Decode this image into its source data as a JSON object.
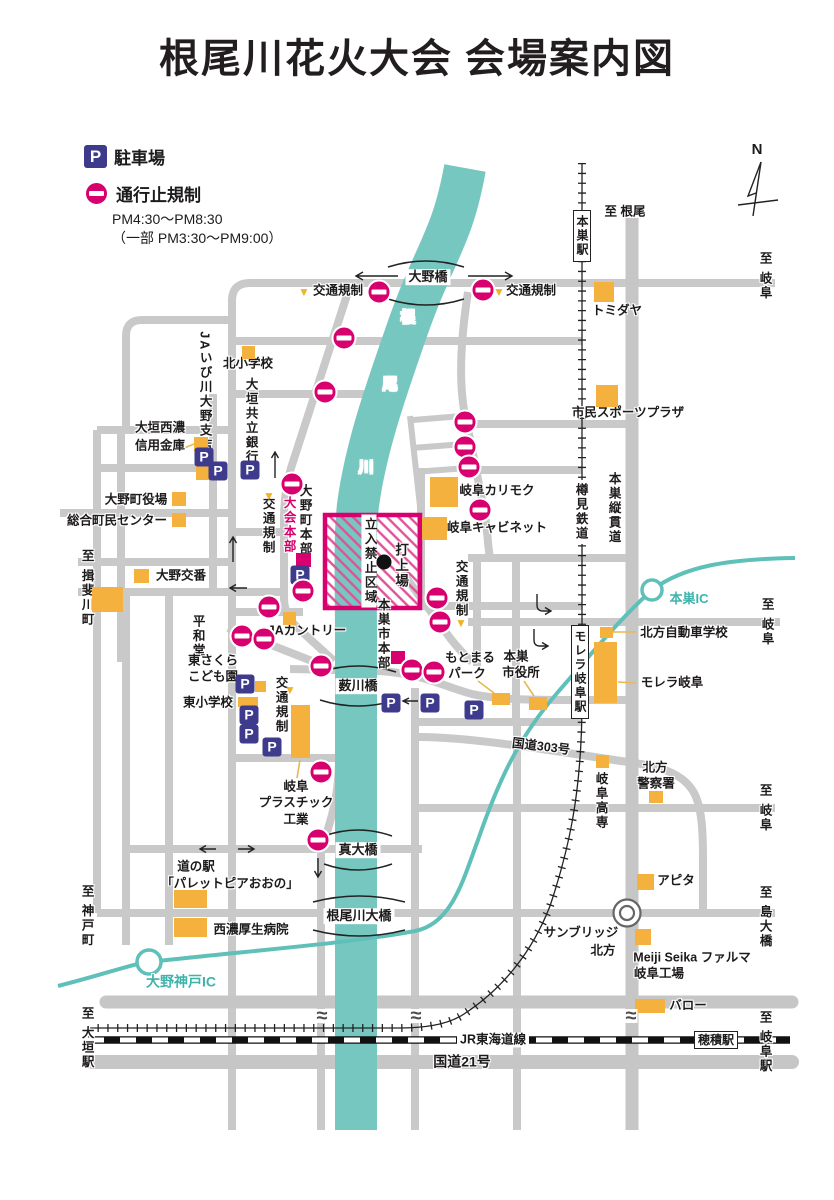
{
  "title": "根尾川花火大会 会場案内図",
  "legend": {
    "parking_symbol": "P",
    "parking_label": "駐車場",
    "closure_label": "通行止規制",
    "closure_time1": "PM4:30〜PM8:30",
    "closure_time2": "（一部 PM3:30〜PM9:00）"
  },
  "colors": {
    "magenta": "#d7006e",
    "orange": "#f4b13d",
    "navy": "#3e3a8c",
    "river": "#77c7c1",
    "highway": "#5fc0b9",
    "road": "#c9c9c9",
    "triangle_yellow": "#efb32a",
    "text": "#1d1a1a"
  },
  "symbols": {
    "triangle": "▼",
    "wave": "≈"
  },
  "map": {
    "labels": [
      {
        "n": "compass-n",
        "t": "N",
        "x": 757,
        "y": 150,
        "s": 15
      },
      {
        "n": "to-neo",
        "t": "至 根尾",
        "x": 625,
        "y": 212
      },
      {
        "n": "to-gifu-top",
        "t": "至 岐阜",
        "x": 764,
        "y": 276,
        "v": 1
      },
      {
        "n": "tomidaya",
        "t": "トミダヤ",
        "x": 617,
        "y": 311
      },
      {
        "n": "shimin-sports-plaza",
        "t": "市民スポーツプラザ",
        "x": 628,
        "y": 413
      },
      {
        "n": "kotsu-kisei-1",
        "t": "交通規制",
        "x": 338,
        "y": 291
      },
      {
        "n": "kotsu-kisei-2",
        "t": "交通規制",
        "x": 531,
        "y": 291
      },
      {
        "n": "river-1",
        "t": "根",
        "x": 408,
        "y": 318,
        "c": "#fff",
        "s": 15
      },
      {
        "n": "river-2",
        "t": "尾",
        "x": 390,
        "y": 385,
        "c": "#fff",
        "s": 15
      },
      {
        "n": "river-3",
        "t": "川",
        "x": 366,
        "y": 468,
        "c": "#fff",
        "s": 15
      },
      {
        "n": "kita-elementary",
        "t": "北小学校",
        "x": 248,
        "y": 364
      },
      {
        "n": "ja-ibigawa",
        "t": "JAいび川大野支店",
        "x": 204,
        "y": 392,
        "v": 1
      },
      {
        "n": "ogaki-kyoritsu-bank",
        "t": "大垣共立銀行",
        "x": 250,
        "y": 421,
        "v": 1
      },
      {
        "n": "ogaki-seino-1",
        "t": "大垣西濃",
        "x": 160,
        "y": 428
      },
      {
        "n": "ogaki-seino-2",
        "t": "信用金庫",
        "x": 160,
        "y": 446
      },
      {
        "n": "onocho-yakuba",
        "t": "大野町役場",
        "x": 136,
        "y": 500
      },
      {
        "n": "sogo-chomin-center",
        "t": "総合町民センター",
        "x": 117,
        "y": 521
      },
      {
        "n": "ono-koban",
        "t": "大野交番",
        "x": 181,
        "y": 576
      },
      {
        "n": "to-ibigawacho",
        "t": "至 揖斐川町",
        "x": 86,
        "y": 588,
        "v": 1
      },
      {
        "n": "heiwado",
        "t": "平和堂",
        "x": 197,
        "y": 636,
        "v": 1
      },
      {
        "n": "kotsu-kisei-3",
        "t": "交通規制",
        "x": 267,
        "y": 526,
        "v": 1
      },
      {
        "n": "taikai-honbu",
        "t": "大会本部",
        "x": 288,
        "y": 525,
        "v": 1,
        "c": "#d7006e"
      },
      {
        "n": "onocho-honbu",
        "t": "大野町本部",
        "x": 304,
        "y": 520,
        "v": 1
      },
      {
        "n": "restricted-zone",
        "t": "立入禁止区域",
        "x": 369,
        "y": 561,
        "v": 1,
        "bg": 1
      },
      {
        "n": "launch-site",
        "t": "打上場",
        "x": 400,
        "y": 566,
        "v": 1,
        "s": 13.5
      },
      {
        "n": "kotsu-kisei-4",
        "t": "交通規制",
        "x": 460,
        "y": 589,
        "v": 1
      },
      {
        "n": "gifu-karimoku",
        "t": "岐阜カリモク",
        "x": 497,
        "y": 491
      },
      {
        "n": "gifu-cabinet",
        "t": "岐阜キャビネット",
        "x": 497,
        "y": 528
      },
      {
        "n": "tarumi-railway",
        "t": "樽見鉄道",
        "x": 580,
        "y": 512,
        "v": 1,
        "bg": 1
      },
      {
        "n": "motosu-jukando",
        "t": "本巣縦貫道",
        "x": 613,
        "y": 508,
        "v": 1
      },
      {
        "n": "motosu-ic",
        "t": "本巣IC",
        "x": 689,
        "y": 599,
        "c": "#3fb3ab",
        "s": 13
      },
      {
        "n": "to-gifu-mid",
        "t": "至 岐阜",
        "x": 766,
        "y": 622,
        "v": 1
      },
      {
        "n": "ja-country",
        "t": "JAカントリー",
        "x": 307,
        "y": 631
      },
      {
        "n": "motosu-shi-honbu",
        "t": "本巣市本部",
        "x": 382,
        "y": 634,
        "v": 1
      },
      {
        "n": "motomaru-park-1",
        "t": "もとまる",
        "x": 470,
        "y": 658
      },
      {
        "n": "motomaru-park-2",
        "t": "パーク",
        "x": 467,
        "y": 674
      },
      {
        "n": "motosu-shiyakusho-1",
        "t": "本巣",
        "x": 516,
        "y": 657
      },
      {
        "n": "motosu-shiyakusho-2",
        "t": "市役所",
        "x": 521,
        "y": 673
      },
      {
        "n": "kitagata-driving-school",
        "t": "北方自動車学校",
        "x": 684,
        "y": 633
      },
      {
        "n": "malera-gifu",
        "t": "モレラ岐阜",
        "x": 672,
        "y": 683
      },
      {
        "n": "higashi-sakura-1",
        "t": "東さくら",
        "x": 213,
        "y": 661
      },
      {
        "n": "higashi-sakura-2",
        "t": "こども園",
        "x": 213,
        "y": 677
      },
      {
        "n": "higashi-elementary",
        "t": "東小学校",
        "x": 208,
        "y": 703
      },
      {
        "n": "kotsu-kisei-5",
        "t": "交通規制",
        "x": 280,
        "y": 705,
        "v": 1
      },
      {
        "n": "gifu-plastic-1",
        "t": "岐阜",
        "x": 296,
        "y": 787
      },
      {
        "n": "gifu-plastic-2",
        "t": "プラスチック",
        "x": 296,
        "y": 803
      },
      {
        "n": "gifu-plastic-3",
        "t": "工業",
        "x": 296,
        "y": 820
      },
      {
        "n": "route-303",
        "t": "国道303号",
        "x": 541,
        "y": 747,
        "rot": 7
      },
      {
        "n": "gifu-kosen",
        "t": "岐阜高専",
        "x": 600,
        "y": 801,
        "v": 1
      },
      {
        "n": "kitagata-police-1",
        "t": "北方",
        "x": 655,
        "y": 768
      },
      {
        "n": "kitagata-police-2",
        "t": "警察署",
        "x": 656,
        "y": 784
      },
      {
        "n": "to-gifu-low",
        "t": "至 岐阜",
        "x": 764,
        "y": 808,
        "v": 1
      },
      {
        "n": "michinoeki-1",
        "t": "道の駅",
        "x": 196,
        "y": 867
      },
      {
        "n": "michinoeki-2",
        "t": "「パレットピアおおの」",
        "x": 230,
        "y": 884
      },
      {
        "n": "seino-kosei-hospital",
        "t": "西濃厚生病院",
        "x": 251,
        "y": 930
      },
      {
        "n": "ono-kobe-ic",
        "t": "大野神戸IC",
        "x": 181,
        "y": 982,
        "c": "#3fb3ab",
        "s": 14
      },
      {
        "n": "to-kobecho",
        "t": "至 神戸町",
        "x": 86,
        "y": 916,
        "v": 1
      },
      {
        "n": "apita",
        "t": "アピタ",
        "x": 676,
        "y": 881
      },
      {
        "n": "to-shimaohashi",
        "t": "至 島大橋",
        "x": 764,
        "y": 917,
        "v": 1
      },
      {
        "n": "sunbridge-1",
        "t": "サンブリッジ",
        "x": 581,
        "y": 933
      },
      {
        "n": "sunbridge-2",
        "t": "北方",
        "x": 603,
        "y": 951
      },
      {
        "n": "meiji-seika-1",
        "t": "Meiji Seika ファルマ",
        "x": 692,
        "y": 958
      },
      {
        "n": "meiji-seika-2",
        "t": "岐阜工場",
        "x": 659,
        "y": 974
      },
      {
        "n": "valor",
        "t": "バロー",
        "x": 688,
        "y": 1006
      },
      {
        "n": "jr-tokaido-line",
        "t": "JR東海道線",
        "x": 493,
        "y": 1040,
        "bg": 1
      },
      {
        "n": "route-21",
        "t": "国道21号",
        "x": 462,
        "y": 1062,
        "s": 14
      },
      {
        "n": "to-ogaki-sta",
        "t": "至 大垣駅",
        "x": 86,
        "y": 1038,
        "v": 1
      },
      {
        "n": "to-gifu-sta",
        "t": "至 岐阜駅",
        "x": 764,
        "y": 1042,
        "v": 1
      }
    ],
    "bridges": [
      {
        "n": "ono-bashi",
        "t": "大野橋",
        "x": 428,
        "y": 277
      },
      {
        "n": "yabukawa-bashi",
        "t": "薮川橋",
        "x": 358,
        "y": 686
      },
      {
        "n": "shindai-bashi",
        "t": "真大橋",
        "x": 358,
        "y": 850
      },
      {
        "n": "neogawa-ohashi",
        "t": "根尾川大橋",
        "x": 359,
        "y": 916
      }
    ],
    "stations": [
      {
        "n": "motosu-station",
        "t": "本巣駅",
        "x": 582,
        "y": 236,
        "v": 1
      },
      {
        "n": "malera-gifu-station",
        "t": "モレラ岐阜駅",
        "x": 580,
        "y": 672,
        "v": 1
      },
      {
        "n": "hozumi-station",
        "t": "穂積駅",
        "x": 716,
        "y": 1040,
        "v": 0
      }
    ],
    "buildings": [
      {
        "n": "tomidaya",
        "x": 594,
        "y": 282,
        "w": 20,
        "h": 20
      },
      {
        "n": "shimin-sports",
        "x": 596,
        "y": 385,
        "w": 22,
        "h": 22
      },
      {
        "n": "kita-elementary",
        "x": 242,
        "y": 346,
        "w": 13,
        "h": 13
      },
      {
        "n": "shinyokinko-1",
        "x": 194,
        "y": 437,
        "w": 14,
        "h": 14
      },
      {
        "n": "shinyokinko-2",
        "x": 196,
        "y": 466,
        "w": 13,
        "h": 14
      },
      {
        "n": "yakuba",
        "x": 172,
        "y": 492,
        "w": 14,
        "h": 14
      },
      {
        "n": "chomin-center",
        "x": 172,
        "y": 513,
        "w": 14,
        "h": 14
      },
      {
        "n": "koban",
        "x": 134,
        "y": 569,
        "w": 15,
        "h": 14
      },
      {
        "n": "heiwado",
        "x": 92,
        "y": 587,
        "w": 31,
        "h": 25
      },
      {
        "n": "ja-country",
        "x": 283,
        "y": 612,
        "w": 13,
        "h": 13
      },
      {
        "n": "karimoku",
        "x": 430,
        "y": 477,
        "w": 28,
        "h": 30
      },
      {
        "n": "cabinet",
        "x": 422,
        "y": 517,
        "w": 25,
        "h": 23
      },
      {
        "n": "sakura-kodomoen",
        "x": 255,
        "y": 681,
        "w": 11,
        "h": 11
      },
      {
        "n": "higashi-elementary",
        "x": 238,
        "y": 697,
        "w": 20,
        "h": 10
      },
      {
        "n": "gifu-plastic",
        "x": 291,
        "y": 705,
        "w": 19,
        "h": 53
      },
      {
        "n": "motomaru",
        "x": 492,
        "y": 693,
        "w": 18,
        "h": 12
      },
      {
        "n": "shiyakusho",
        "x": 529,
        "y": 697,
        "w": 18,
        "h": 13
      },
      {
        "n": "driving-school",
        "x": 600,
        "y": 627,
        "w": 13,
        "h": 11
      },
      {
        "n": "malera",
        "x": 594,
        "y": 642,
        "w": 23,
        "h": 61
      },
      {
        "n": "kosen",
        "x": 596,
        "y": 755,
        "w": 13,
        "h": 13
      },
      {
        "n": "police",
        "x": 649,
        "y": 791,
        "w": 14,
        "h": 12
      },
      {
        "n": "michinoeki",
        "x": 174,
        "y": 890,
        "w": 33,
        "h": 18
      },
      {
        "n": "seino-hospital",
        "x": 174,
        "y": 918,
        "w": 33,
        "h": 19
      },
      {
        "n": "apita",
        "x": 637,
        "y": 874,
        "w": 17,
        "h": 16
      },
      {
        "n": "meiji-seika",
        "x": 635,
        "y": 929,
        "w": 16,
        "h": 16
      },
      {
        "n": "valor",
        "x": 635,
        "y": 999,
        "w": 30,
        "h": 14
      }
    ],
    "hq_squares": [
      {
        "n": "taikai-honbu-marker",
        "x": 296,
        "y": 553,
        "w": 15,
        "h": 14
      },
      {
        "n": "motosu-honbu-marker",
        "x": 391,
        "y": 651,
        "w": 14,
        "h": 13
      }
    ],
    "parking": [
      {
        "x": 204,
        "y": 457
      },
      {
        "x": 218,
        "y": 471
      },
      {
        "x": 250,
        "y": 470
      },
      {
        "x": 300,
        "y": 575
      },
      {
        "x": 245,
        "y": 684
      },
      {
        "x": 249,
        "y": 715
      },
      {
        "x": 249,
        "y": 734
      },
      {
        "x": 272,
        "y": 747
      },
      {
        "x": 391,
        "y": 703
      },
      {
        "x": 430,
        "y": 703
      },
      {
        "x": 474,
        "y": 710
      }
    ],
    "no_entry": [
      {
        "x": 379,
        "y": 292
      },
      {
        "x": 483,
        "y": 290
      },
      {
        "x": 344,
        "y": 338
      },
      {
        "x": 325,
        "y": 392
      },
      {
        "x": 292,
        "y": 484
      },
      {
        "x": 303,
        "y": 591
      },
      {
        "x": 269,
        "y": 607
      },
      {
        "x": 242,
        "y": 636
      },
      {
        "x": 264,
        "y": 639
      },
      {
        "x": 321,
        "y": 666
      },
      {
        "x": 437,
        "y": 598
      },
      {
        "x": 440,
        "y": 622
      },
      {
        "x": 412,
        "y": 670
      },
      {
        "x": 434,
        "y": 672
      },
      {
        "x": 465,
        "y": 422
      },
      {
        "x": 465,
        "y": 447
      },
      {
        "x": 469,
        "y": 467
      },
      {
        "x": 480,
        "y": 510
      },
      {
        "x": 321,
        "y": 772
      },
      {
        "x": 318,
        "y": 840
      }
    ],
    "triangles": [
      {
        "x": 304,
        "y": 292
      },
      {
        "x": 499,
        "y": 292
      },
      {
        "x": 269,
        "y": 496
      },
      {
        "x": 461,
        "y": 623
      },
      {
        "x": 290,
        "y": 690
      }
    ],
    "waves": [
      {
        "x": 322,
        "y": 1016
      },
      {
        "x": 416,
        "y": 1016
      },
      {
        "x": 631,
        "y": 1016
      }
    ],
    "launch_dot": {
      "x": 384,
      "y": 562
    }
  }
}
